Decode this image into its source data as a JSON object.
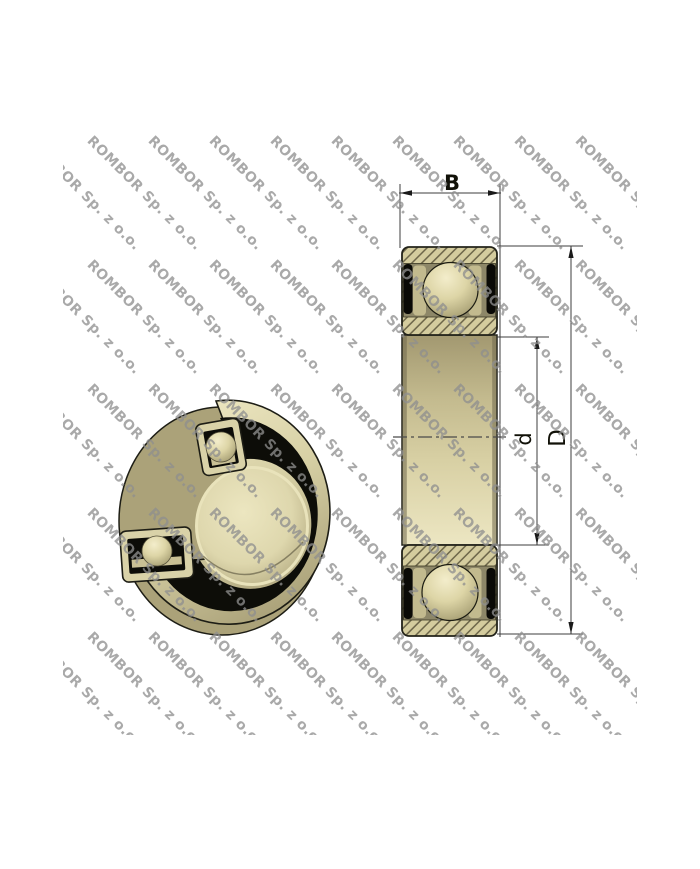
{
  "watermark": {
    "text": "ROMBOR Sp. z o.o.",
    "color": "#8f8f8f"
  },
  "drawing": {
    "dim_width_label": "B",
    "dim_bore_label": "d",
    "dim_outer_label": "D"
  },
  "colors": {
    "bearing_tan": "#d6cfa4",
    "bearing_tan_light": "#ece6c2",
    "bearing_tan_dark": "#a89f74",
    "seal_black": "#0c0c08",
    "hatch_line": "#6b6448",
    "drawing_line": "#3c3c3c",
    "background": "#ffffff"
  }
}
